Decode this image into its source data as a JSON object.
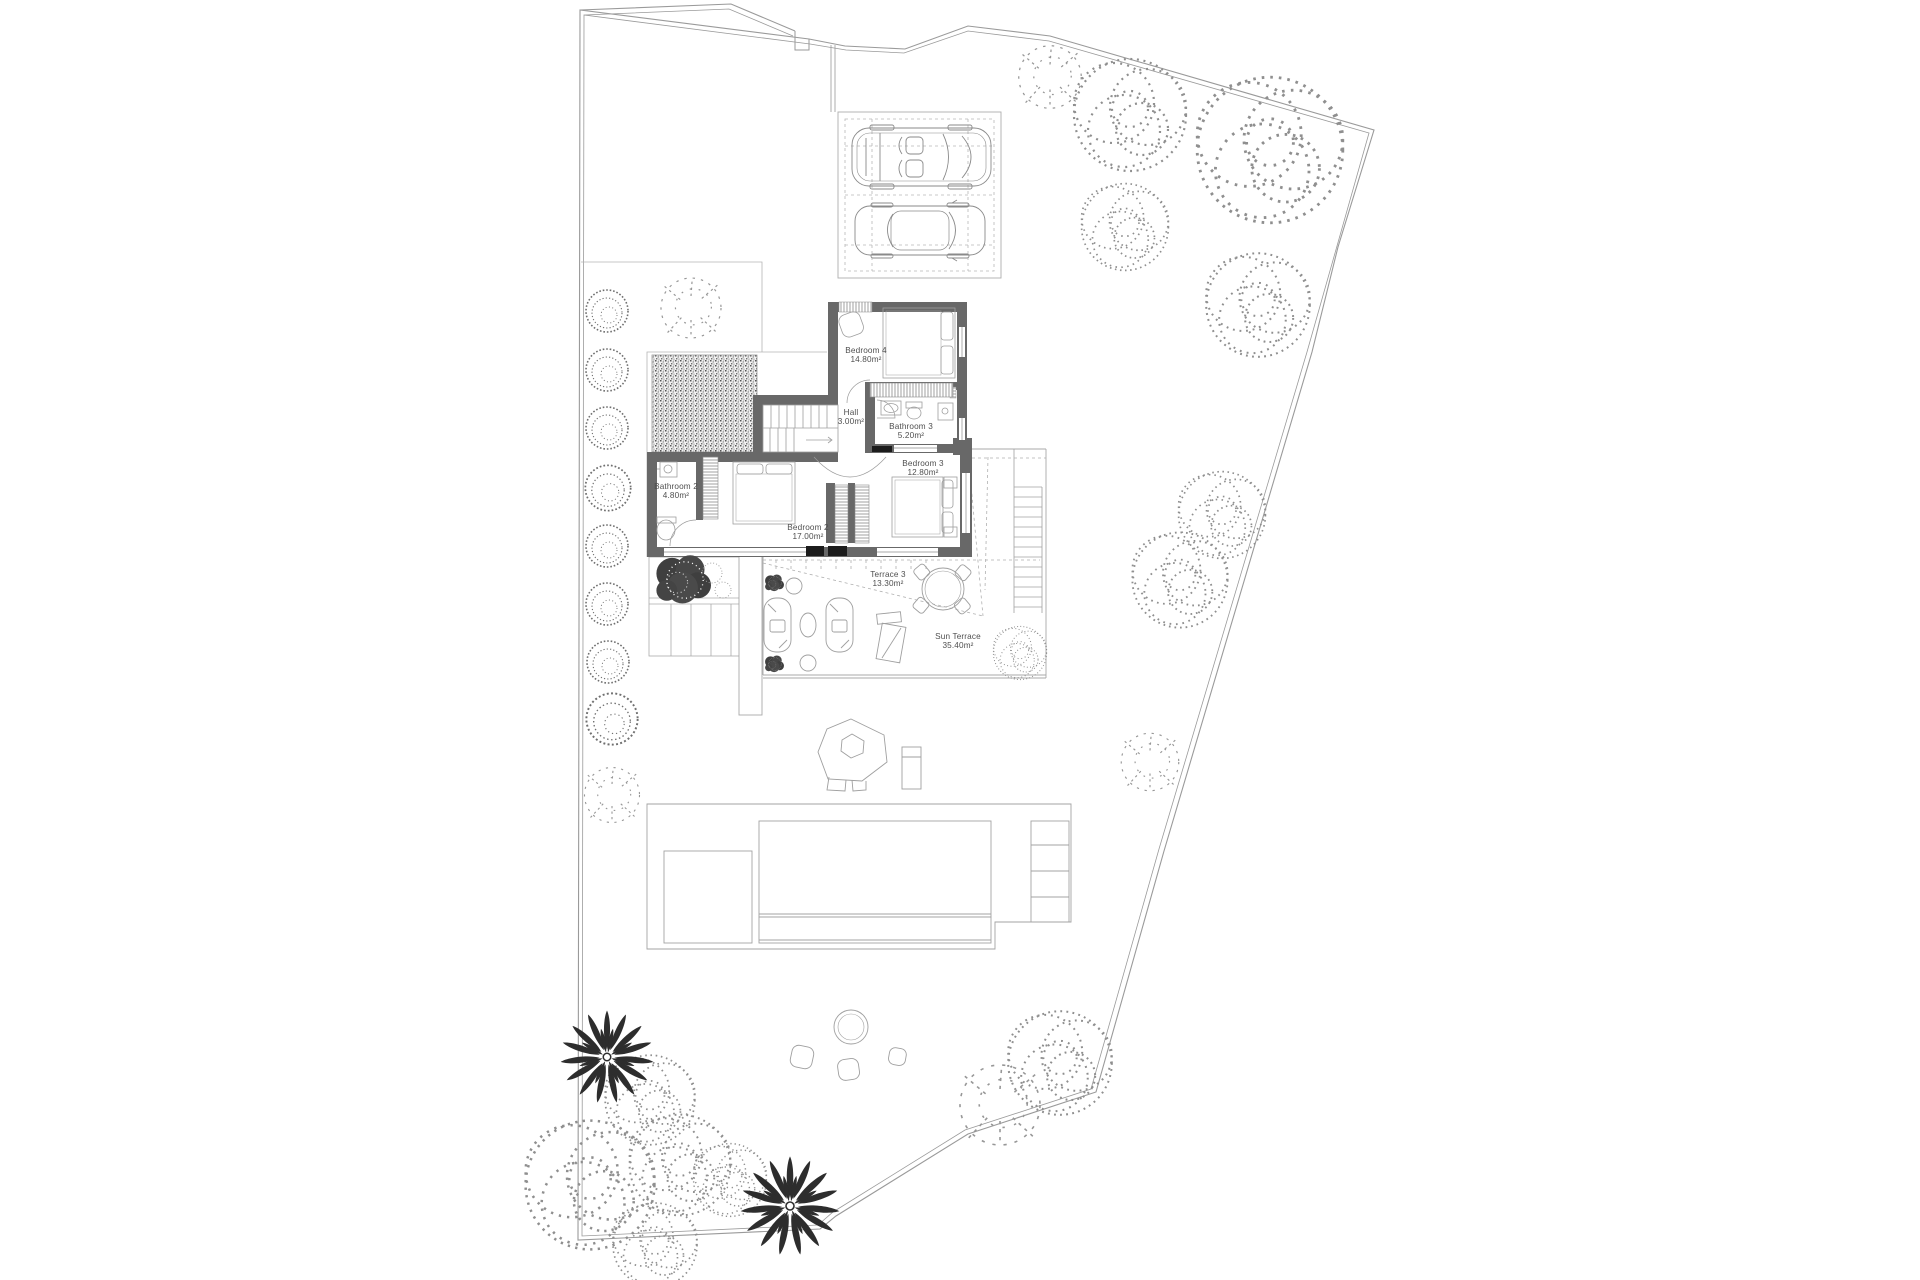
{
  "document": {
    "kind": "architectural-site-plan",
    "floor": "upper floor villa plan with garden, parking, pool and terraces"
  },
  "rooms": [
    {
      "name": "Bedroom 4",
      "area": "14.80m²"
    },
    {
      "name": "Hall",
      "area": "3.00m²"
    },
    {
      "name": "Bathroom 3",
      "area": "5.20m²"
    },
    {
      "name": "Bedroom 3",
      "area": "12.80m²"
    },
    {
      "name": "Bathroom 2",
      "area": "4.80m²"
    },
    {
      "name": "Bedroom 2",
      "area": "17.00m²"
    },
    {
      "name": "Terrace 3",
      "area": "13.30m²"
    },
    {
      "name": "Sun Terrace",
      "area": "35.40m²"
    }
  ],
  "palette": {
    "background": "#ffffff",
    "boundary_line": "#9a9a9a",
    "wall_fill": "#686868",
    "thin_line": "#a8a8a8",
    "dashed_line": "#b0b0b0",
    "text": "#4f4f4f",
    "door_leaf": "#1c1c1c",
    "palm_foliage": "#2d2d2d",
    "dark_plant": "#3f3f3f"
  }
}
